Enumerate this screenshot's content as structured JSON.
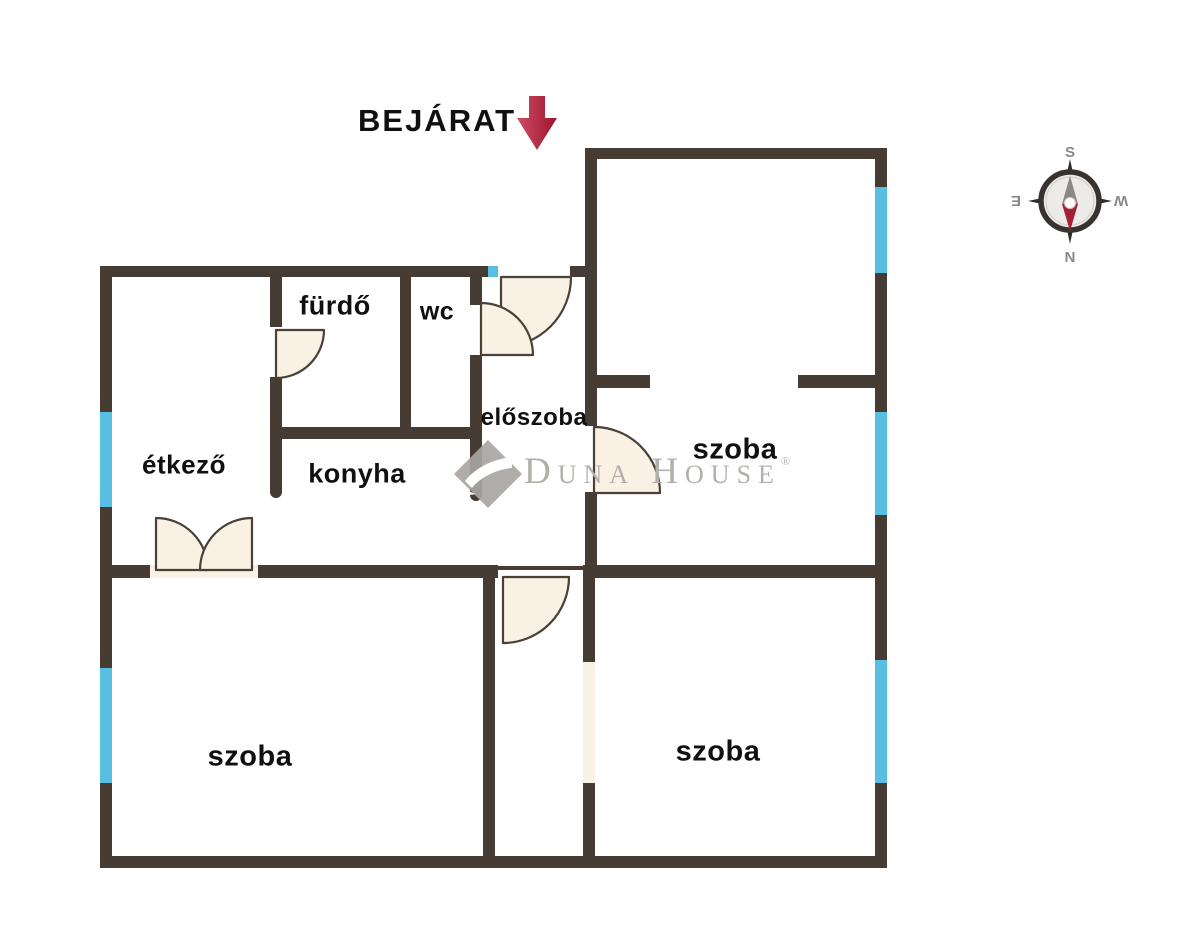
{
  "entrance": {
    "label": "BEJÁRAT",
    "arrow_direction": "down"
  },
  "rooms": {
    "bathroom": {
      "label": "fürdő"
    },
    "toilet": {
      "label": "wc"
    },
    "hallway": {
      "label": "előszoba"
    },
    "dining": {
      "label": "étkező"
    },
    "kitchen": {
      "label": "konyha"
    },
    "room_top_right": {
      "label": "szoba"
    },
    "room_bottom_left": {
      "label": "szoba"
    },
    "room_bottom_right": {
      "label": "szoba"
    }
  },
  "watermark": {
    "brand": "Duna House",
    "registered": "®"
  },
  "compass": {
    "top": "S",
    "bottom": "N",
    "left": "E",
    "right": "W"
  },
  "colors": {
    "wall": "#473c33",
    "window": "#58bfe3",
    "door_fill": "#f9f1e3",
    "door_outline": "#4a4038",
    "arrow": "#b82b46",
    "label": "#101010",
    "watermark": "#b3b0ac",
    "compass_gray": "#8b8885",
    "compass_needle_north": "#a32037",
    "background": "#ffffff"
  }
}
